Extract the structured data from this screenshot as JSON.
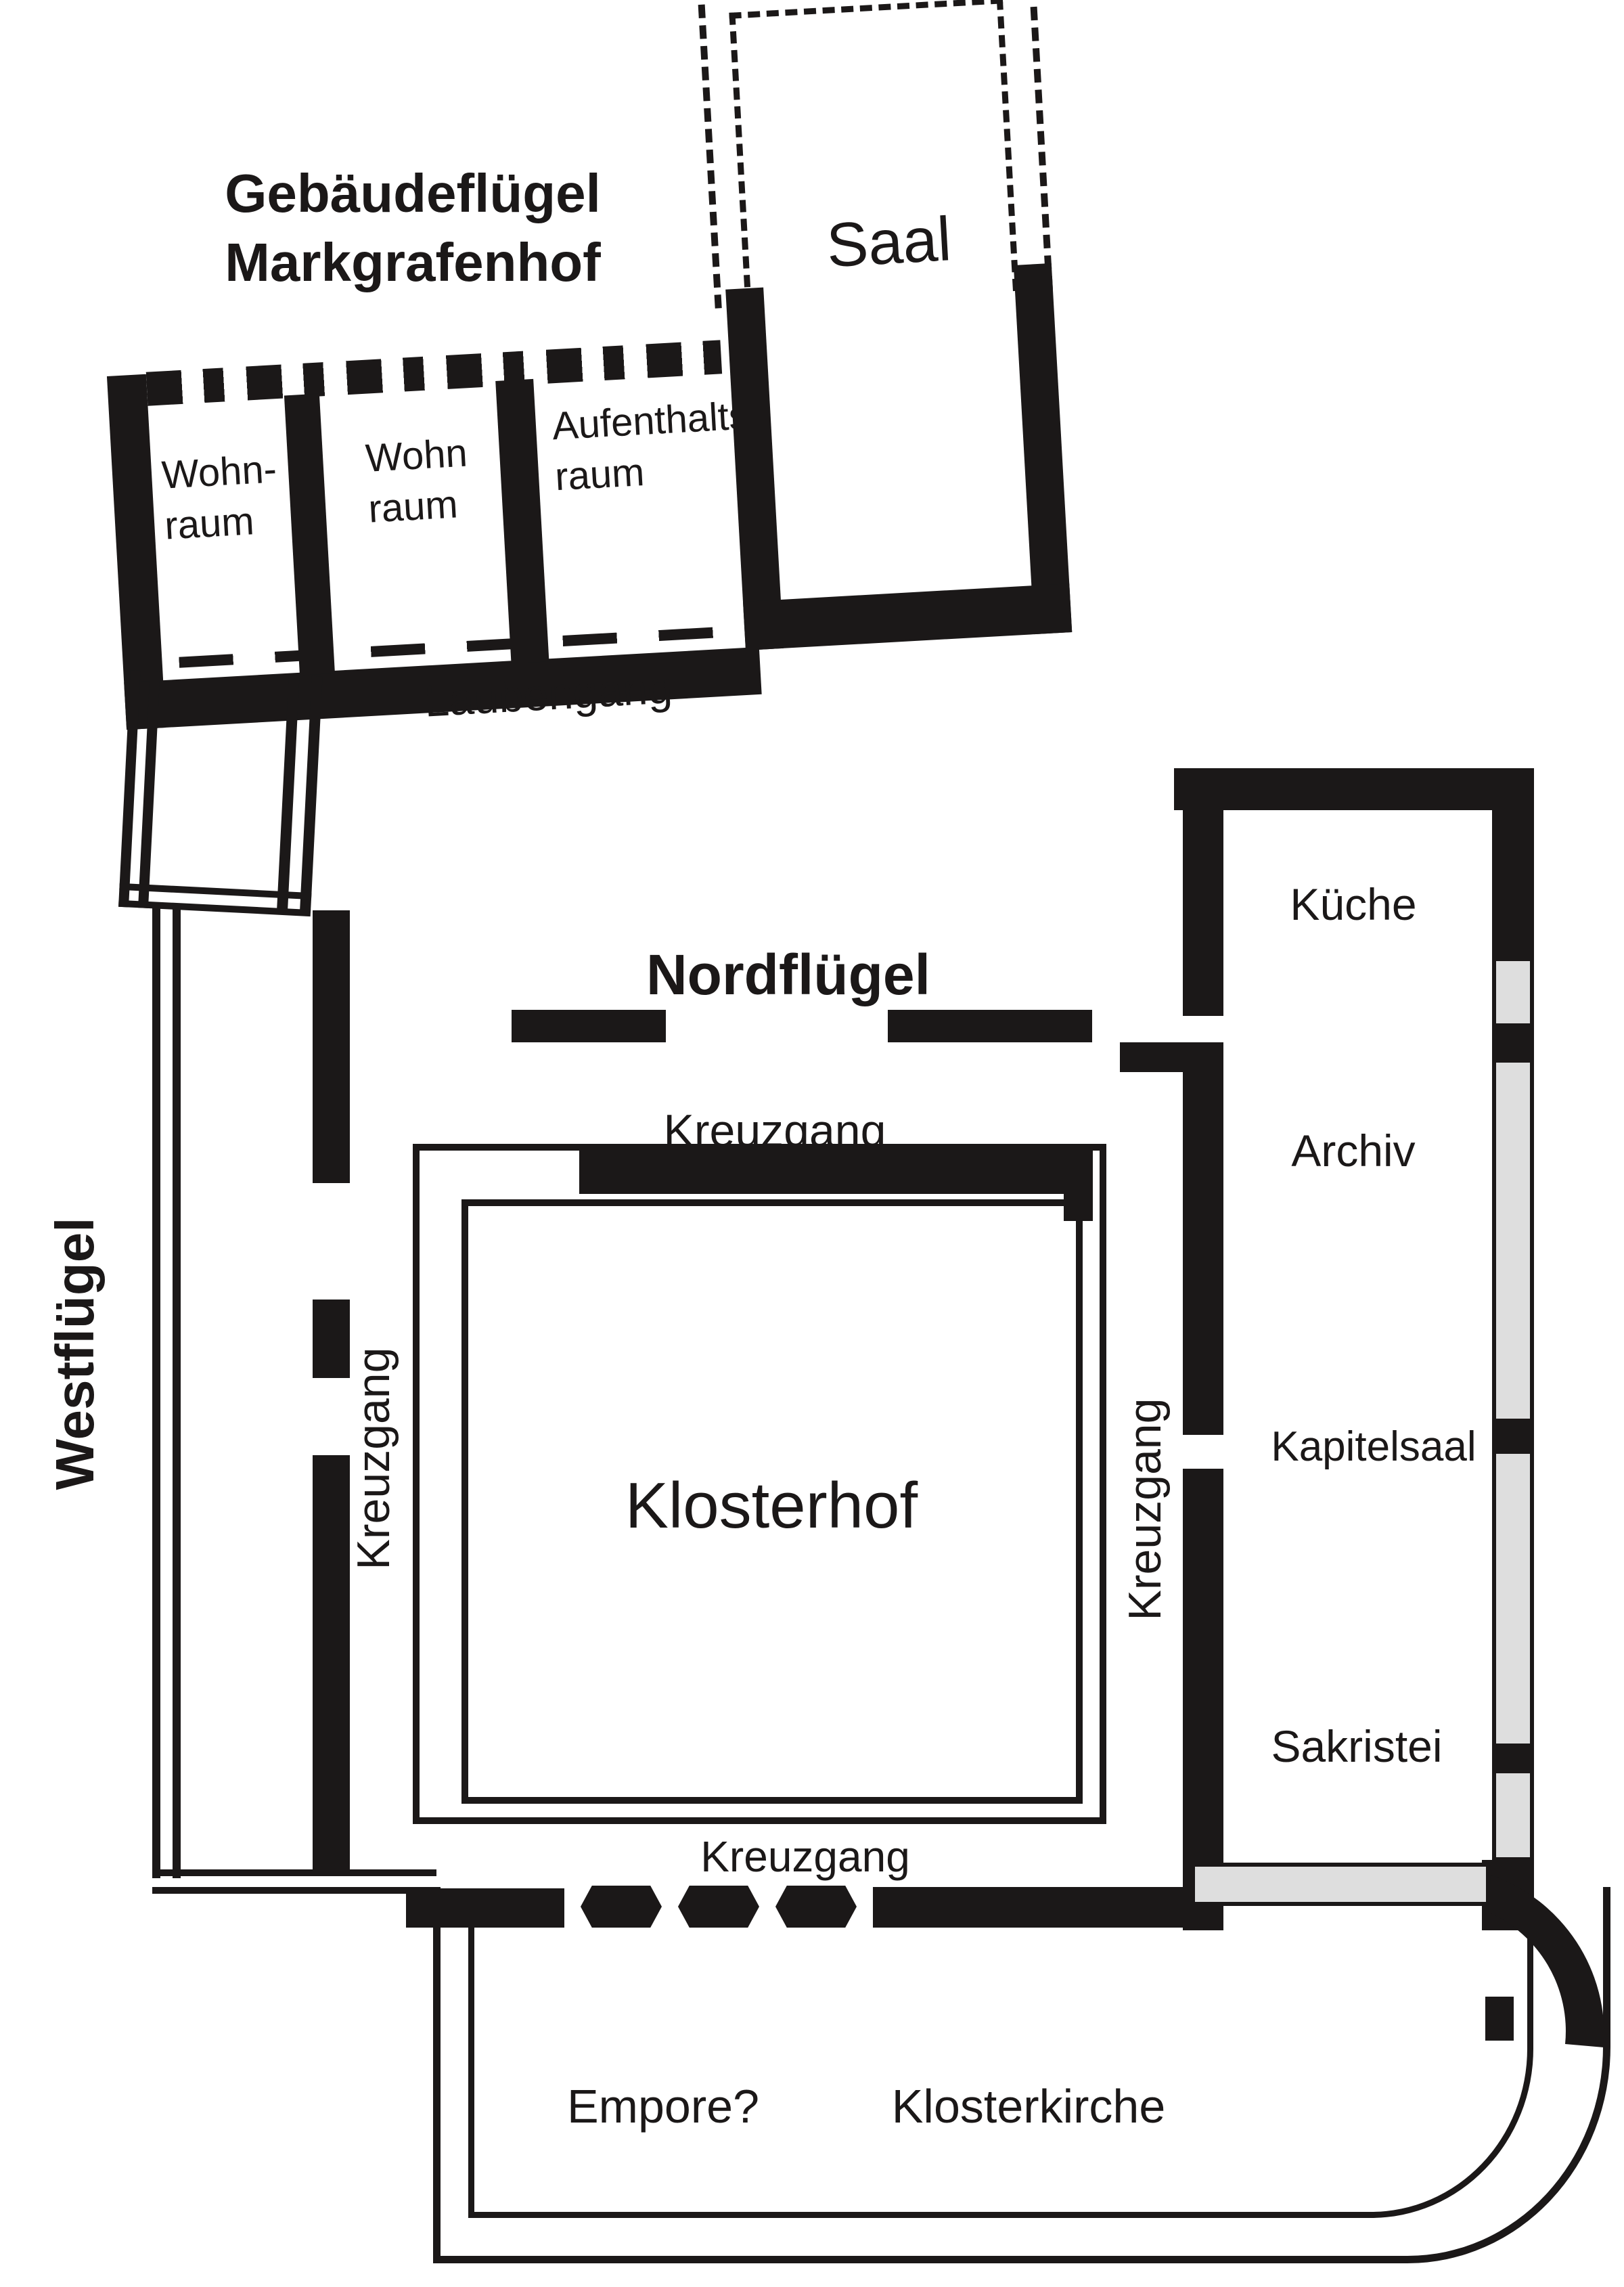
{
  "plan": {
    "type": "floor-plan",
    "background_color": "#ffffff",
    "wall_color": "#1b1818",
    "reconstructed_wall_color": "#dedede",
    "title_lines": [
      "Gebäudeflügel",
      "Markgrafenhof"
    ],
    "labels": {
      "saal": "Saal",
      "laubengang": "Laubengang",
      "westfluegel": "Westflügel",
      "nordfluegel": "Nordflügel",
      "kreuzgang_north": "Kreuzgang",
      "kreuzgang_west": "Kreuzgang",
      "kreuzgang_east": "Kreuzgang",
      "kreuzgang_south": "Kreuzgang",
      "klosterhof": "Klosterhof",
      "kueche": "Küche",
      "archiv": "Archiv",
      "kapitelsaal": "Kapitelsaal",
      "sakristei": "Sakristei",
      "empore": "Empore?",
      "klosterkirche": "Klosterkirche"
    },
    "rooms_top_wing": [
      {
        "id": "wohnraum-1",
        "lines": [
          "Wohn-",
          "raum"
        ]
      },
      {
        "id": "wohnraum-2",
        "lines": [
          "Wohn",
          "raum"
        ]
      },
      {
        "id": "aufenthaltsraum",
        "lines": [
          "Aufenthalts-",
          "raum"
        ]
      }
    ]
  }
}
